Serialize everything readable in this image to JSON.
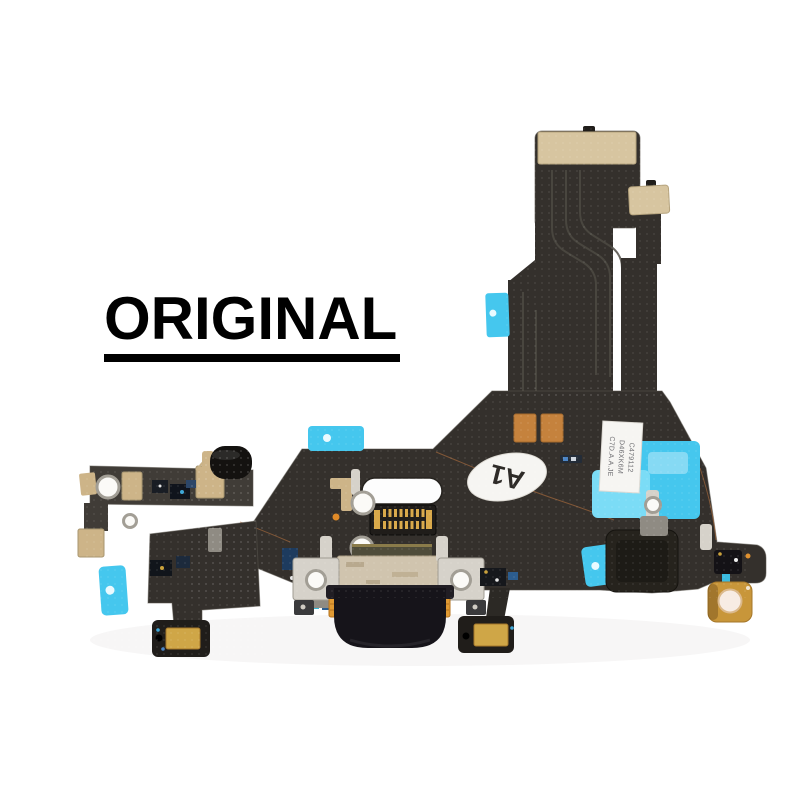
{
  "badge": {
    "text": "ORIGINAL"
  },
  "labels": {
    "model_oval": "A1",
    "sticker_lines": [
      "C479112",
      "D46XK6M",
      "C7D.A.A.JE"
    ]
  },
  "palette": {
    "text-black": "#000000",
    "flex-dark": "#34302c",
    "flex-mid": "#403c37",
    "flex-deep": "#201d1a",
    "pad-champagne": "#d7c5a0",
    "pad-gold": "#cdb488",
    "copper": "#c5823d",
    "adhesive-cyan": "#45c7ee",
    "adhesive-cyan-light": "#7bdcf6",
    "metal-silver": "#d6d2ca",
    "metal-dark": "#8f8b83",
    "port-metal": "#d0c4ae",
    "port-olive": "#4f4c3a",
    "mic-gold": "#cfa647",
    "label-white": "#f6f5f2",
    "housing-black": "#16141a"
  }
}
